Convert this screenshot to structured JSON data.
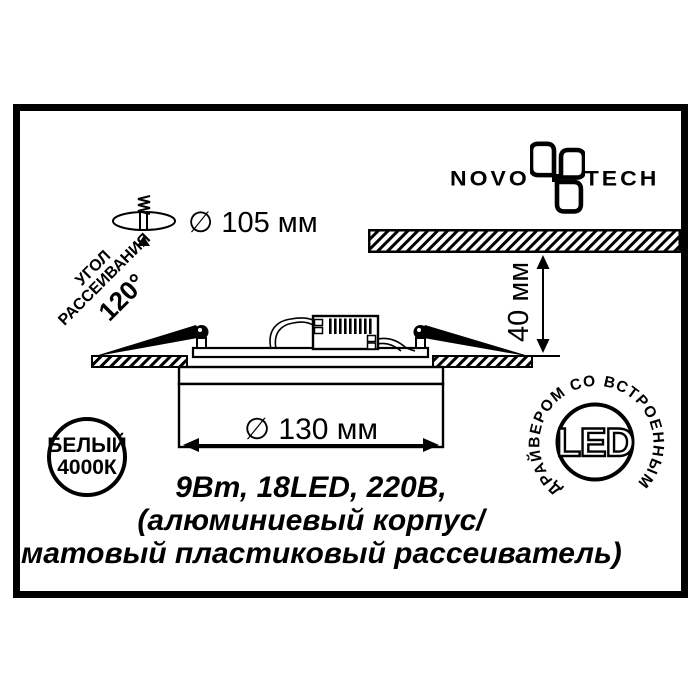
{
  "brand": {
    "prefix": "NOVO",
    "suffix": "TECH"
  },
  "dimensions": {
    "cutout": "∅ 105 мм",
    "depth": "40 мм",
    "diameter": "∅ 130 мм"
  },
  "beam_angle": {
    "word1": "УГОЛ",
    "word2": "РАССЕИВАНИЯ",
    "value": "120°"
  },
  "badges": {
    "color_temp": {
      "line1": "БЕЛЫЙ",
      "line2": "4000К"
    },
    "led": {
      "label": "LED",
      "ring_text": "ДРАЙВЕРОМ СО ВСТРОЕННЫМ"
    }
  },
  "specs": {
    "line1": "9Вт, 18LED, 220В,",
    "line2": "(алюминиевый корпус/",
    "line3": "матовый пластиковый рассеиватель)"
  },
  "colors": {
    "ink": "#000000",
    "paper": "#ffffff"
  }
}
